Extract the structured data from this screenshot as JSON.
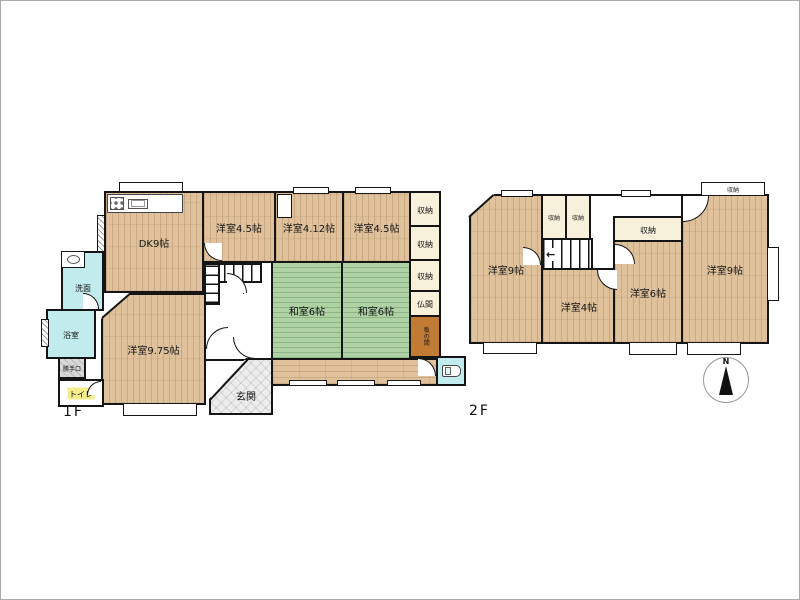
{
  "floor1": {
    "label": "1F",
    "rooms": {
      "dk": "DK9帖",
      "western_45_a": "洋室4.5帖",
      "western_412": "洋室4.12帖",
      "western_45_b": "洋室4.5帖",
      "storage_1": "収納",
      "storage_2": "収納",
      "storage_3": "収納",
      "butsuma": "仏間",
      "itanoma": "板の間",
      "japanese_6_a": "和室6帖",
      "japanese_6_b": "和室6帖",
      "western_975": "洋室9.75帖",
      "washroom": "洗面",
      "bathroom": "浴室",
      "back_door": "勝手口",
      "toilet": "トイレ",
      "entrance": "玄関"
    }
  },
  "floor2": {
    "label": "2F",
    "rooms": {
      "western_9_left": "洋室9帖",
      "storage_a": "収納",
      "storage_b": "収納",
      "storage_mid": "収納",
      "storage_top_right": "収納",
      "western_4": "洋室4帖",
      "western_6": "洋室6帖",
      "western_9_right": "洋室9帖"
    }
  },
  "compass": {
    "north": "N"
  },
  "stairs": {
    "floor1_arrow": "→",
    "floor2_arrow": "←"
  },
  "colors": {
    "wood": "#dfc29c",
    "tatami": "#aed2a4",
    "water_room": "#c2ebee",
    "closet": "#f7f0da",
    "itanoma": "#c17b34",
    "entrance_tile": "#ededed",
    "toilet_label_highlight": "#f6ee8d",
    "wall": "#151515"
  }
}
